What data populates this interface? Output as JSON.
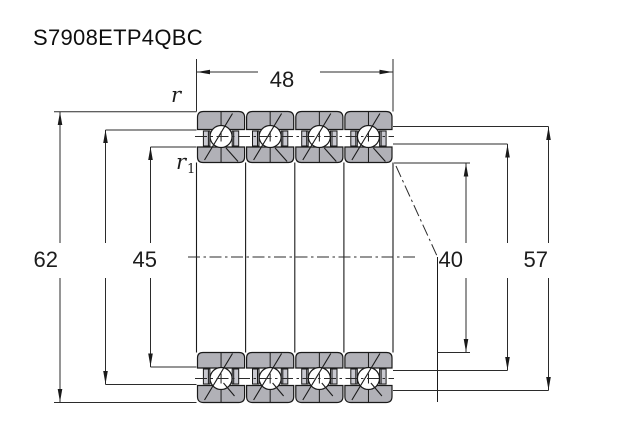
{
  "title": "S7908ETP4QBC",
  "dims": {
    "width": "48",
    "outer_diameter": "62",
    "left_shoulder_diameter": "45",
    "bore_diameter": "40",
    "right_shoulder_diameter": "57",
    "chamfer_outer": "r",
    "chamfer_inner_base": "r",
    "chamfer_inner_sub": "1"
  },
  "drawing": {
    "bearing_units": 4,
    "colors": {
      "ring_fill": "#b1b1b7",
      "line": "#1a1a1a",
      "dimension_line": "#2b2b2b"
    }
  }
}
